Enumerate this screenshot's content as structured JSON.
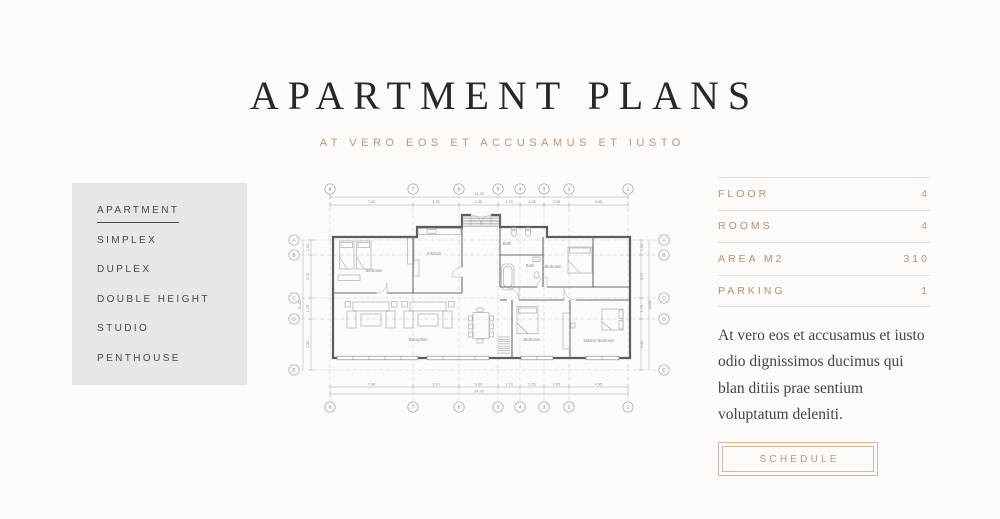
{
  "header": {
    "title": "APARTMENT PLANS",
    "subtitle": "AT VERO EOS ET ACCUSAMUS ET IUSTO"
  },
  "sidebar": {
    "items": [
      {
        "label": "APARTMENT",
        "active": true
      },
      {
        "label": "SIMPLEX",
        "active": false
      },
      {
        "label": "DUPLEX",
        "active": false
      },
      {
        "label": "DOUBLE HEIGHT",
        "active": false
      },
      {
        "label": "STUDIO",
        "active": false
      },
      {
        "label": "PENTHOUSE",
        "active": false
      }
    ]
  },
  "plan": {
    "grid_columns": [
      "8",
      "7",
      "6",
      "5",
      "4",
      "3",
      "2",
      "1"
    ],
    "grid_rows": [
      "A",
      "B",
      "C",
      "D",
      "E"
    ],
    "dims_horizontal": [
      "7.00",
      "3.70",
      "3.30",
      "1.70",
      "2.05",
      "2.05",
      "4.95"
    ],
    "dim_total_horizontal": "24.75",
    "dims_vertical": [
      "1.00",
      "3.75",
      "1.75",
      "4.30"
    ],
    "dim_total_vertical": "10.80",
    "rooms": [
      "Bedroom",
      "Kitchen",
      "Bath",
      "Bath",
      "Bedroom",
      "Reception",
      "Bedroom",
      "Master Bedroom"
    ]
  },
  "details": {
    "rows": [
      {
        "label": "FLOOR",
        "value": "4"
      },
      {
        "label": "ROOMS",
        "value": "4"
      },
      {
        "label": "AREA M2",
        "value": "310"
      },
      {
        "label": "PARKING",
        "value": "1"
      }
    ],
    "description": "At vero eos et accusamus et iusto odio dignissimos ducimus qui blan ditiis prae sentium voluptatum deleniti.",
    "button_label": "SCHEDULE"
  },
  "colors": {
    "accent": "#bd937a",
    "button_border": "#d9b8a0",
    "panel": "#e9e7e3",
    "title": "#26292c",
    "body_text": "#3e444b",
    "plan_line": "#5c5c5c"
  }
}
